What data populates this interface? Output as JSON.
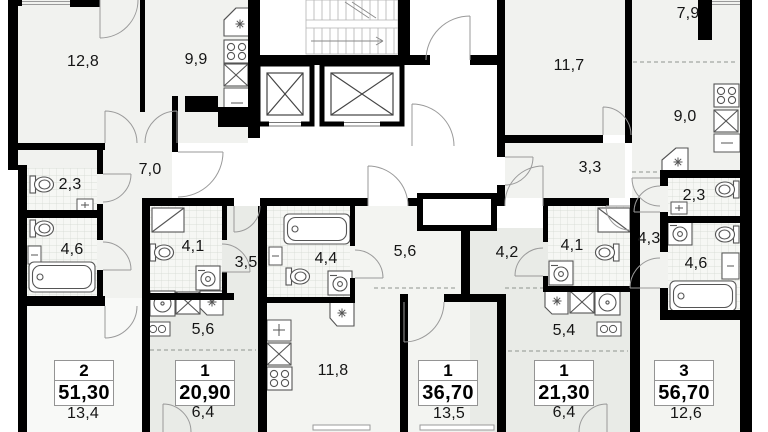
{
  "icons": {
    "vent": "asterisk-flower",
    "elevator": "crossed-box-shaft",
    "staircase": "stair-flight-with-arrow"
  },
  "units": [
    {
      "stamp": {
        "rooms": "2",
        "area": "51,30"
      },
      "room_areas": {
        "bedroom": "12,8",
        "kitchen": "9,9",
        "hall": "7,0",
        "wc": "2,3",
        "bathroom": "4,6",
        "living": "13,4"
      }
    },
    {
      "stamp": {
        "rooms": "1",
        "area": "20,90"
      },
      "room_areas": {
        "bathroom": "4,1",
        "hall": "3,5",
        "kitchen": "5,6",
        "living": "6,4"
      }
    },
    {
      "stamp": {
        "rooms": "1",
        "area": "36,70"
      },
      "room_areas": {
        "bathroom": "4,4",
        "hall": "5,6",
        "kitchen": "11,8",
        "living": "13,5"
      }
    },
    {
      "stamp": {
        "rooms": "1",
        "area": "21,30"
      },
      "room_areas": {
        "hall": "4,2",
        "bathroom": "4,1",
        "kitchen": "5,4",
        "living": "6,4"
      }
    },
    {
      "stamp": {
        "rooms": "3",
        "area": "56,70"
      },
      "room_areas": {
        "bedroom": "11,7",
        "bedroom2": "7,9",
        "kitchen": "9,0",
        "hall": "3,3",
        "hall2": "4,3",
        "wc": "2,3",
        "bathroom": "4,6",
        "living": "12,6"
      }
    }
  ]
}
